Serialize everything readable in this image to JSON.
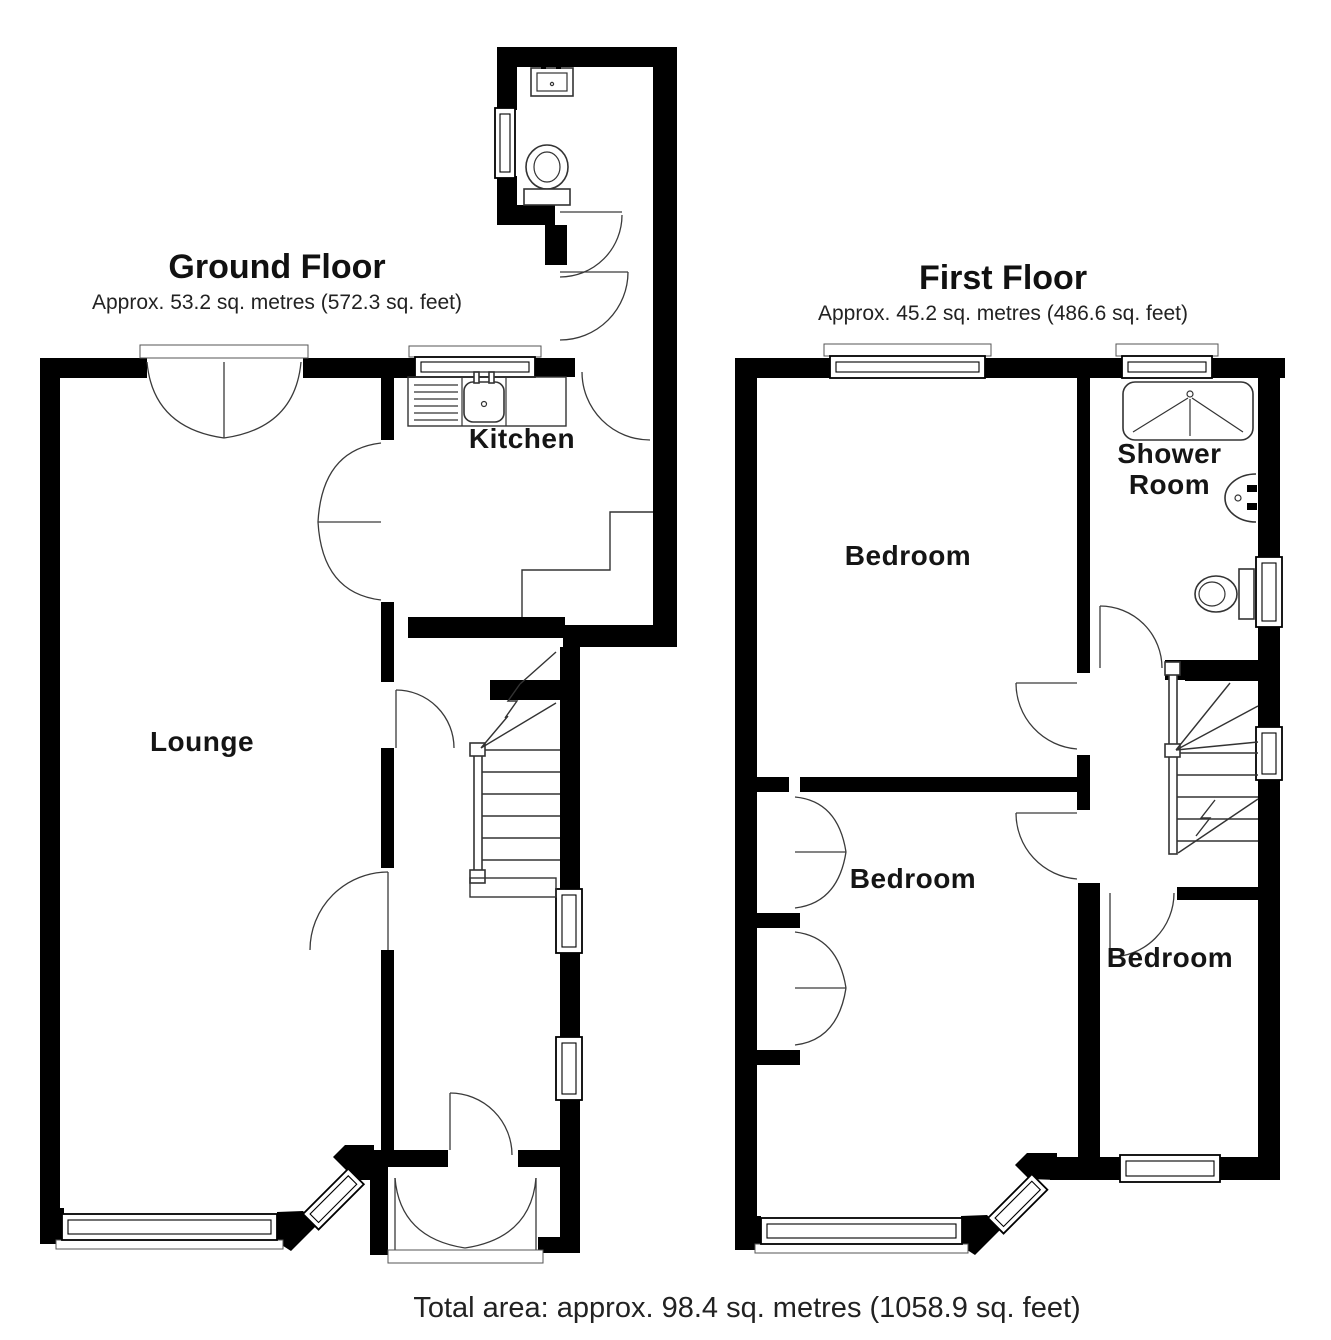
{
  "page": {
    "background": "#ffffff",
    "wall_color": "#000000",
    "line_color": "#333333"
  },
  "ground_floor": {
    "title": "Ground Floor",
    "area": "Approx. 53.2 sq. metres (572.3 sq. feet)",
    "rooms": {
      "kitchen": "Kitchen",
      "lounge": "Lounge"
    }
  },
  "first_floor": {
    "title": "First Floor",
    "area": "Approx. 45.2 sq. metres (486.6 sq. feet)",
    "rooms": {
      "bedroom_top": "Bedroom",
      "bedroom_middle": "Bedroom",
      "bedroom_right": "Bedroom",
      "shower_room": "Shower Room"
    }
  },
  "footer": {
    "total_area": "Total area: approx. 98.4 sq. metres (1058.9 sq. feet)"
  }
}
